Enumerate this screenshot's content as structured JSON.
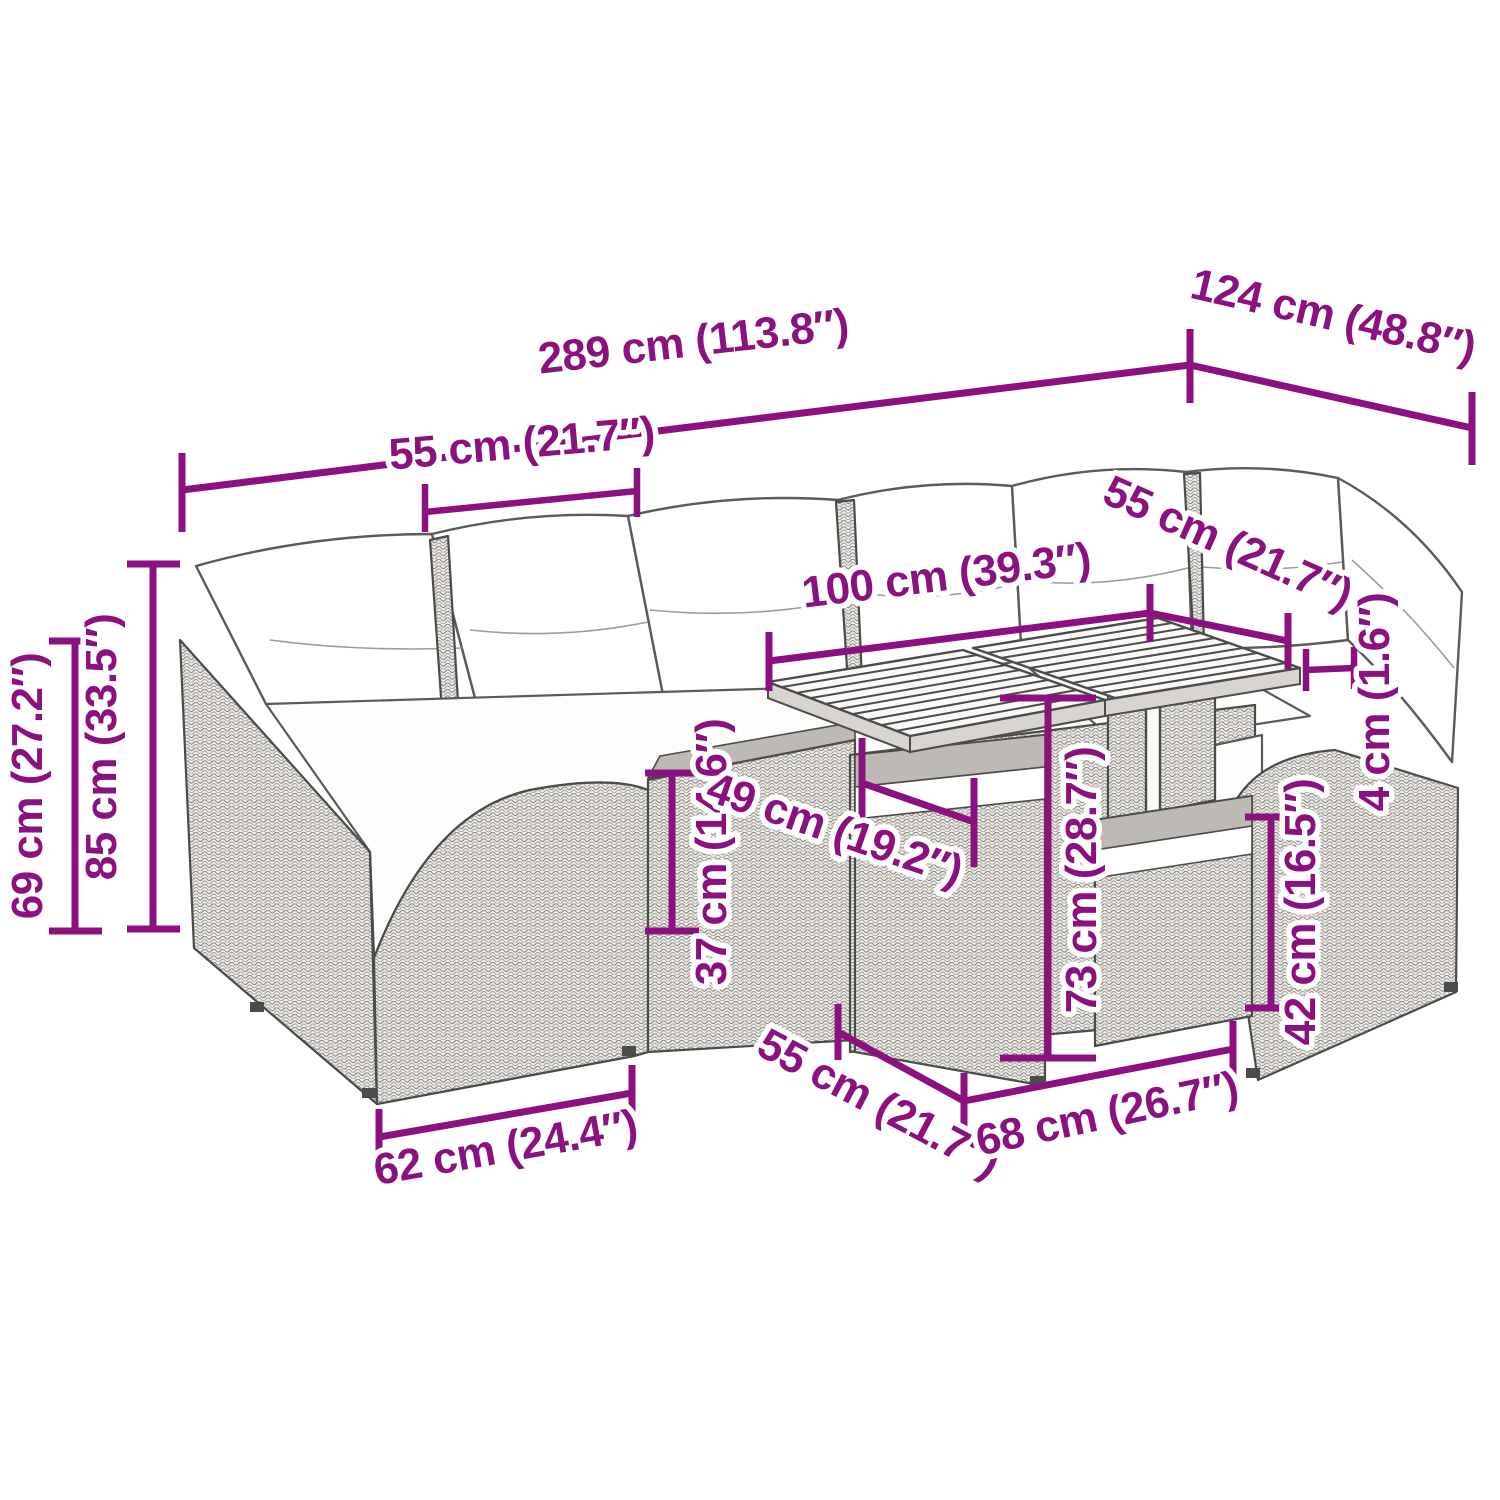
{
  "diagram": {
    "kind": "furniture-dimension-diagram",
    "accent_color": "#8B127E",
    "line_art_color": "#4b4b4b",
    "dimensions": {
      "overall_width": {
        "label": "289 cm (113.8″)"
      },
      "overall_depth": {
        "label": "124 cm (48.8″)"
      },
      "back_cushion_width": {
        "label": "55 cm (21.7″)"
      },
      "table_top_length": {
        "label": "100 cm (39.3″)"
      },
      "corner_cushion_width": {
        "label": "55 cm (21.7″)"
      },
      "backrest_height": {
        "label": "69 cm (27.2″)"
      },
      "overall_height": {
        "label": "85 cm (33.5″)"
      },
      "seat_height": {
        "label": "37 cm (14.6″)"
      },
      "table_base_width": {
        "label": "49 cm (19.2″)"
      },
      "table_height": {
        "label": "73 cm (28.7″)"
      },
      "table_top_thickness": {
        "label": "4 cm (1.6″)"
      },
      "armrest_height": {
        "label": "42 cm (16.5″)"
      },
      "seat_module_width": {
        "label": "62 cm (24.4″)"
      },
      "table_top_depth": {
        "label": "55 cm (21.7″)"
      },
      "table_base_length": {
        "label": "68 cm (26.7″)"
      }
    }
  }
}
